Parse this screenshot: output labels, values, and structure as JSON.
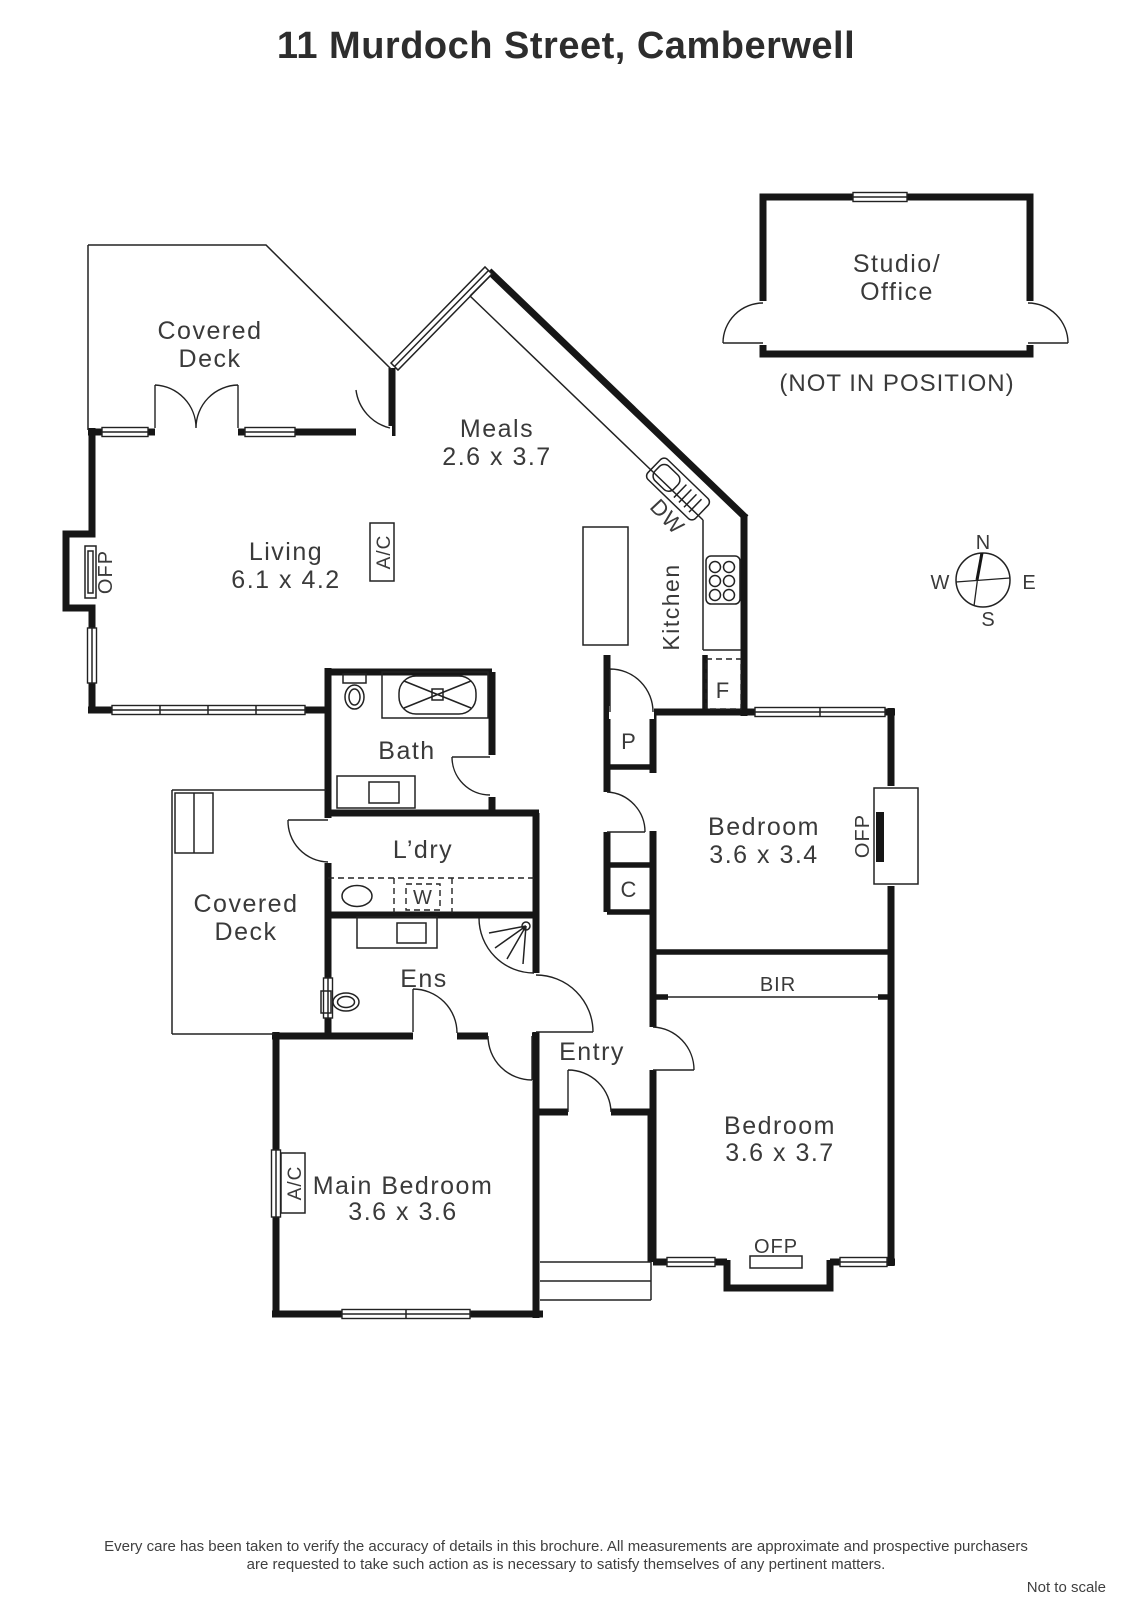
{
  "title": "11 Murdoch Street, Camberwell",
  "rooms": {
    "covered_deck_top": {
      "line1": "Covered",
      "line2": "Deck"
    },
    "meals": {
      "name": "Meals",
      "dims": "2.6 x 3.7"
    },
    "living": {
      "name": "Living",
      "dims": "6.1 x 4.2"
    },
    "kitchen": {
      "name": "Kitchen"
    },
    "bath": {
      "name": "Bath"
    },
    "laundry": {
      "name": "L’dry"
    },
    "covered_deck_left": {
      "line1": "Covered",
      "line2": "Deck"
    },
    "ensuite": {
      "name": "Ens"
    },
    "entry": {
      "name": "Entry"
    },
    "bedroom_1": {
      "name": "Bedroom",
      "dims": "3.6 x 3.4"
    },
    "bedroom_2": {
      "name": "Bedroom",
      "dims": "3.6 x 3.7"
    },
    "main_bedroom": {
      "name": "Main Bedroom",
      "dims": "3.6 x 3.6"
    },
    "studio": {
      "line1": "Studio/",
      "line2": "Office",
      "note": "(NOT IN POSITION)"
    }
  },
  "labels": {
    "ofp": "OFP",
    "ac": "A/C",
    "dw": "DW",
    "fridge": "F",
    "pantry": "P",
    "cupboard": "C",
    "washer": "W",
    "bir": "BIR"
  },
  "compass": {
    "north": "N",
    "south": "S",
    "east": "E",
    "west": "W"
  },
  "footer": {
    "line1": "Every care has been taken to verify the accuracy of details in this brochure.  All measurements are approximate and prospective purchasers",
    "line2": "are requested to take such action as is necessary to satisfy themselves of any pertinent matters.",
    "scale_note": "Not to scale"
  },
  "colors": {
    "wall": "#161616",
    "text": "#3a3a3a",
    "background": "#ffffff"
  }
}
